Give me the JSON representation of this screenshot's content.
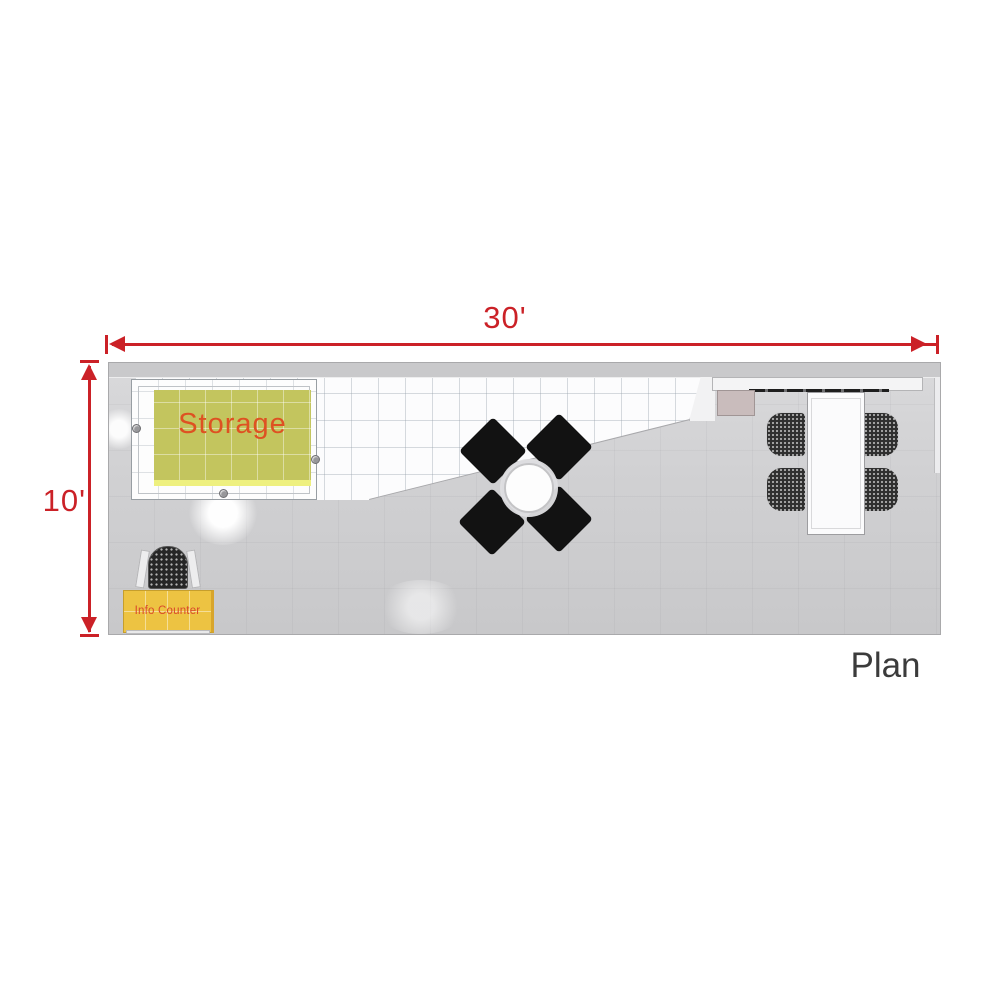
{
  "plan": {
    "title_label": "Plan",
    "dimensions": {
      "width": "30'",
      "depth": "10'"
    },
    "areas": {
      "storage": {
        "label": "Storage",
        "fill_color": "#c3c55e",
        "label_color": "#de5122"
      },
      "info_counter": {
        "label": "Info Counter",
        "fill_color": "#edc342",
        "label_color": "#d9482a"
      }
    },
    "furniture": {
      "round_table": {
        "shape": "circle",
        "chairs": 4,
        "chair_color": "#121212"
      },
      "conference_table": {
        "shape": "rectangle",
        "chairs": 4,
        "chair_color": "#2f2f2f"
      },
      "info_counter_chair": {
        "count": 1
      },
      "back_counter_shelf": {
        "count": 1
      }
    },
    "colors": {
      "dimension_red": "#cb2127",
      "plan_text": "#3b3b3b",
      "floor_gray": "#d0d0d2",
      "tile_white": "#fcfcfd"
    }
  }
}
